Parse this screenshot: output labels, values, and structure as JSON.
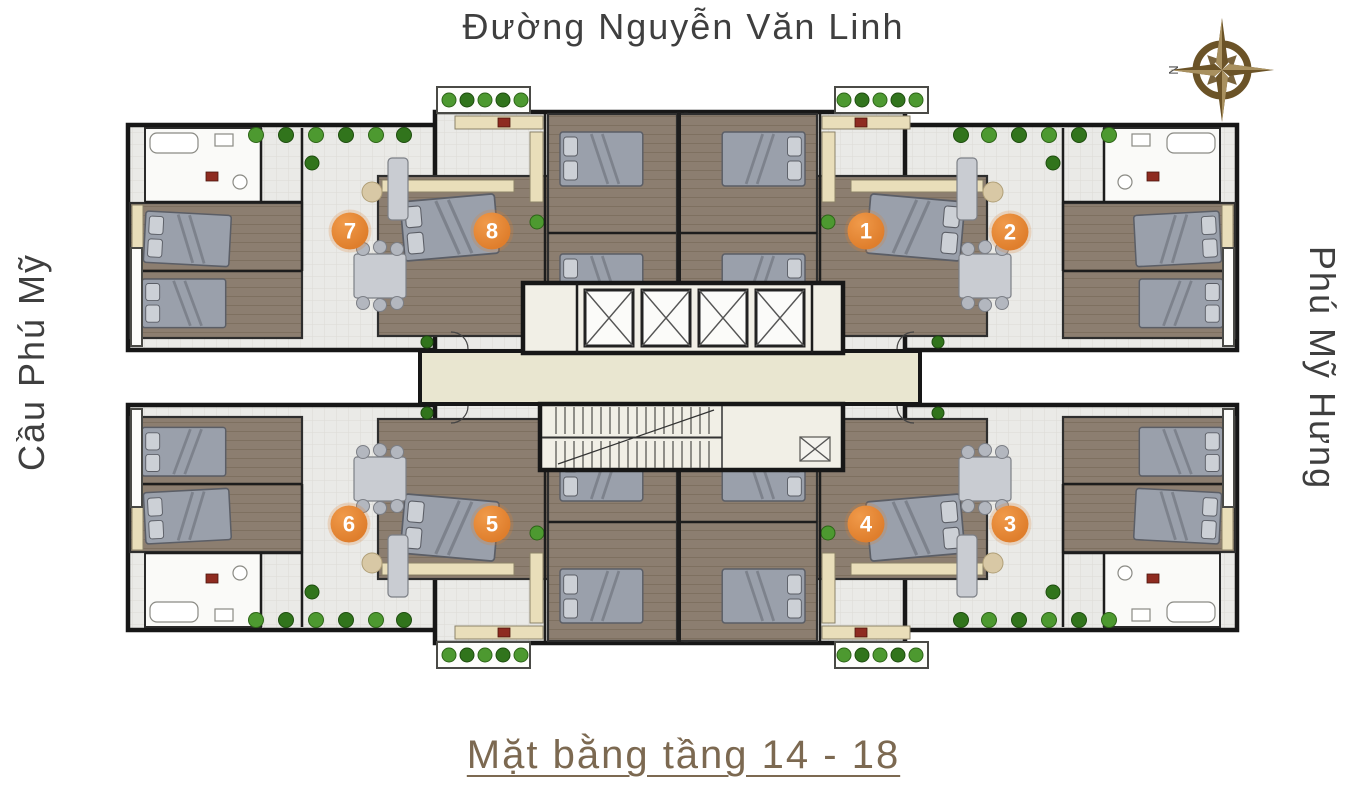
{
  "labels": {
    "top_street": "Đường Nguyễn Văn Linh",
    "left_street": "Cầu Phú Mỹ",
    "right_street": "Phú Mỹ Hưng",
    "caption": "Mặt bằng tầng 14 - 18"
  },
  "compass": {
    "letter": "N"
  },
  "units": [
    {
      "number": "1",
      "x": 866,
      "y": 231
    },
    {
      "number": "2",
      "x": 1010,
      "y": 232
    },
    {
      "number": "3",
      "x": 1010,
      "y": 524
    },
    {
      "number": "4",
      "x": 866,
      "y": 524
    },
    {
      "number": "5",
      "x": 492,
      "y": 524
    },
    {
      "number": "6",
      "x": 349,
      "y": 524
    },
    {
      "number": "7",
      "x": 350,
      "y": 231
    },
    {
      "number": "8",
      "x": 492,
      "y": 231
    }
  ],
  "colors": {
    "badge": "#df7e2c",
    "badge_text": "#ffffff",
    "caption": "#7c6951",
    "street_text": "#3f3f3f",
    "wall": "#171717",
    "corridor": "#e9e6d0",
    "compass": "#6b5327"
  }
}
